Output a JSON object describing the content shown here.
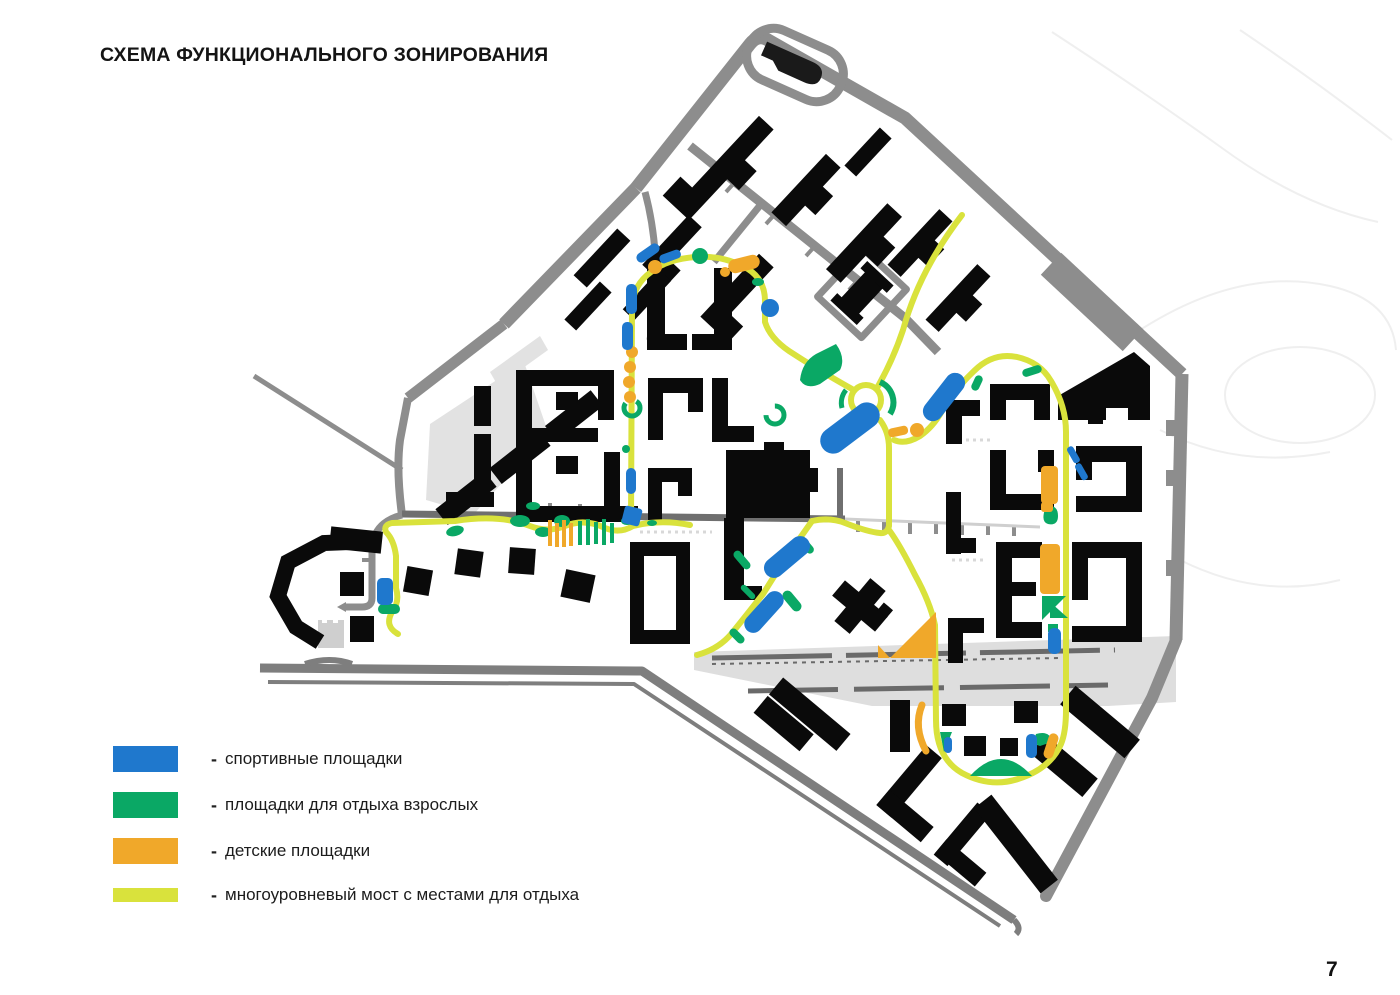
{
  "title": "СХЕМА ФУНКЦИОНАЛЬНОГО ЗОНИРОВАНИЯ",
  "page_number": "7",
  "legend": {
    "dash": "-",
    "items": [
      {
        "id": "sports",
        "label": "спортивные площадки",
        "color": "#1f78cd"
      },
      {
        "id": "adult-rest",
        "label": "площадки для отдыха взрослых",
        "color": "#0aa865"
      },
      {
        "id": "children",
        "label": "детские площадки",
        "color": "#f0a82a"
      },
      {
        "id": "bridge",
        "label": "многоуровневый мост с местами для отдыха",
        "color": "#d9e23c"
      }
    ]
  },
  "map_colors": {
    "building": "#0a0a0a",
    "road": "#8d8d8d",
    "road_dark": "#6f6f6f",
    "paving": "#e2e2e2",
    "corridor": "#dedede",
    "rail": "#6a6a6a",
    "contour": "#efefef"
  }
}
